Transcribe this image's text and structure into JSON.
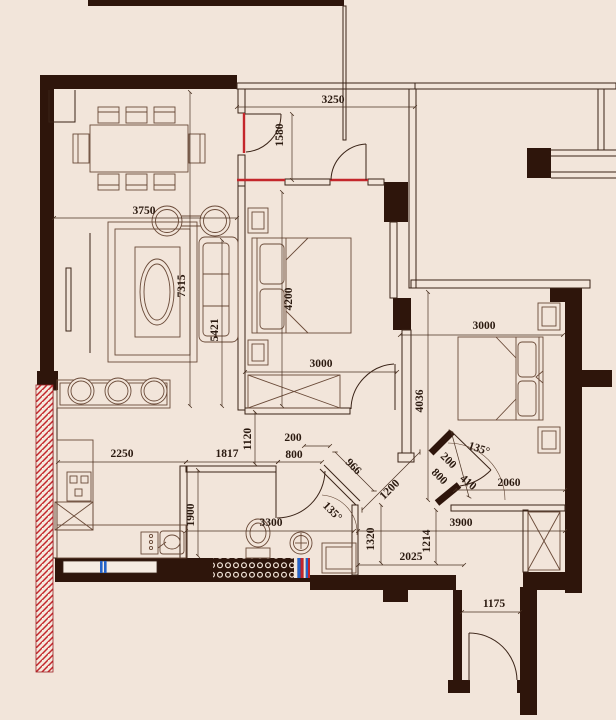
{
  "plan": {
    "type": "apartment-floor-plan",
    "colors": {
      "background": "#f2e5da",
      "wall": "#2e150b",
      "line": "#3a2317",
      "accent_red": "#c4262b",
      "accent_blue": "#2563c9",
      "tile_dot": "#f2e5da"
    },
    "dims": {
      "hall_width": "3250",
      "hall_depth": "1580",
      "dining_width": "3750",
      "living_length": "7315",
      "living_inner": "5421",
      "bedroom1_length": "4200",
      "bedroom1_width": "3000",
      "bedroom2_width": "3000",
      "bedroom2_length": "4036",
      "kitchen_width": "2250",
      "kitchen_to_bath": "1817",
      "passage": "1120",
      "bath_jamb": "200",
      "bath_door": "800",
      "bath_depth": "1900",
      "bath_width": "3300",
      "diag_wall": "966",
      "diag_passage": "1200",
      "bath_angle": "135°",
      "door_jamb": "200",
      "bedroom2_door": "800",
      "door_offset": "410",
      "closet_width": "2060",
      "door_angle": "135°",
      "corridor_left": "1320",
      "corridor_right": "1214",
      "bottom_width": "3900",
      "corridor_width": "2025",
      "entry_width": "1175"
    }
  }
}
